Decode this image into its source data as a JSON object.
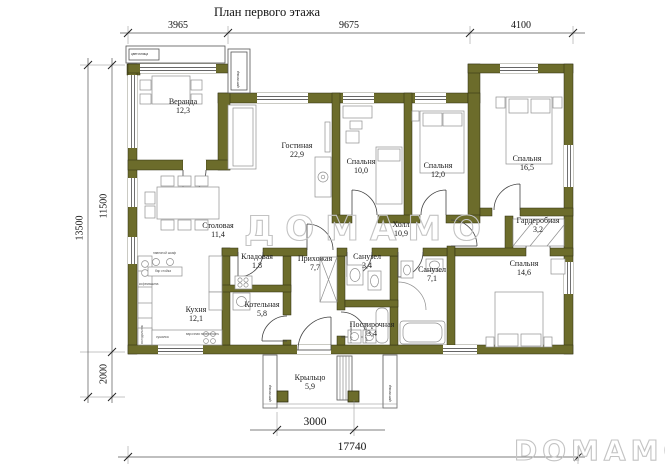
{
  "title": "План первого этажа",
  "watermarks": {
    "center": "ДОМАМО",
    "corner": "DOMAMO"
  },
  "colors": {
    "wall": "#6c6c2b",
    "line": "#444444",
    "dim": "#555555",
    "background": "#ffffff"
  },
  "dimensions": {
    "top": [
      "3965",
      "9675",
      "4100"
    ],
    "left": {
      "total": "13500",
      "upper": "11500",
      "lower": "2000"
    },
    "bottom": {
      "porch": "3000",
      "total": "17740"
    }
  },
  "rooms": [
    {
      "name": "Веранда",
      "area": "12,3"
    },
    {
      "name": "Гостиная",
      "area": "22,9"
    },
    {
      "name": "Спальня",
      "area": "10,0"
    },
    {
      "name": "Спальня",
      "area": "12,0"
    },
    {
      "name": "Спальня",
      "area": "16,5"
    },
    {
      "name": "Холл",
      "area": "10,9"
    },
    {
      "name": "Гардеробная",
      "area": "3,2"
    },
    {
      "name": "Столовая",
      "area": "11,4"
    },
    {
      "name": "Кладовая",
      "area": "1,8"
    },
    {
      "name": "Прихожая",
      "area": "7,7"
    },
    {
      "name": "Санузел",
      "area": "3,4"
    },
    {
      "name": "Санузел",
      "area": "7,1"
    },
    {
      "name": "Спальня",
      "area": "14,6"
    },
    {
      "name": "Кухня",
      "area": "12,1"
    },
    {
      "name": "Котельная",
      "area": "5,8"
    },
    {
      "name": "Постирочная",
      "area": "3,4"
    },
    {
      "name": "Крыльцо",
      "area": "5,9"
    }
  ],
  "planter_label": "цветочница",
  "furniture_labels": [
    "навесной шкаф",
    "бар стойка",
    "кофемашина",
    "холодильник",
    "сушилка",
    "варочная поверхность",
    "стир. машина",
    "суш. машина"
  ]
}
